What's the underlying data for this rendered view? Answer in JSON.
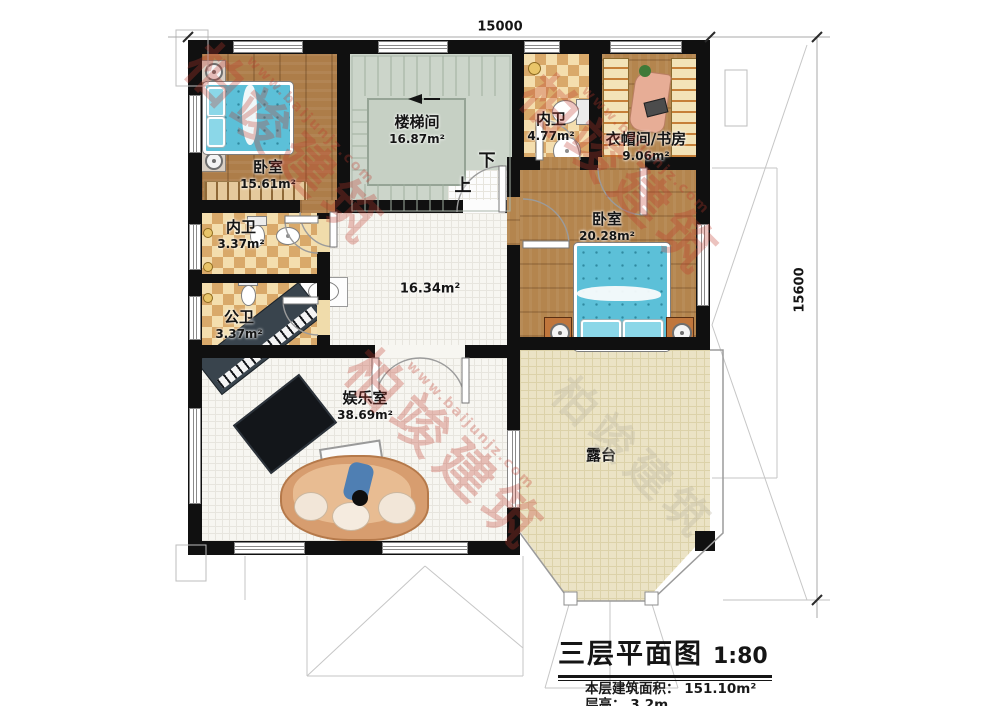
{
  "title_block": {
    "title": "三层平面图",
    "scale": "1:80",
    "area_label": "本层建筑面积：",
    "area_value": "151.10m²",
    "height_label": "层高：",
    "height_value": "3.2m"
  },
  "dimensions": {
    "top": "15000",
    "right": "15600"
  },
  "stairs": {
    "down": "下",
    "up": "上"
  },
  "watermark": {
    "brand": "柏竣建筑",
    "url": "www.baijunjz.com"
  },
  "rooms": {
    "bedroom_nw": {
      "name": "卧室",
      "area": "15.61m²"
    },
    "stairwell": {
      "name": "楼梯间",
      "area": "16.87m²"
    },
    "bath_north": {
      "name": "内卫",
      "area": "4.77m²"
    },
    "cloak_study": {
      "name": "衣帽间/书房",
      "area": "9.06m²"
    },
    "bedroom_east": {
      "name": "卧室",
      "area": "20.28m²"
    },
    "bath_inner": {
      "name": "内卫",
      "area": "3.37m²"
    },
    "bath_public": {
      "name": "公卫",
      "area": "3.37m²"
    },
    "hall": {
      "area": "16.34m²"
    },
    "entertainment": {
      "name": "娱乐室",
      "area": "38.69m²"
    },
    "terrace": {
      "name": "露台"
    }
  },
  "colors": {
    "wall": "#101010",
    "bed": "#5cc0d8",
    "watermark_red": "#c0392b",
    "wood": "#ad7d49"
  }
}
